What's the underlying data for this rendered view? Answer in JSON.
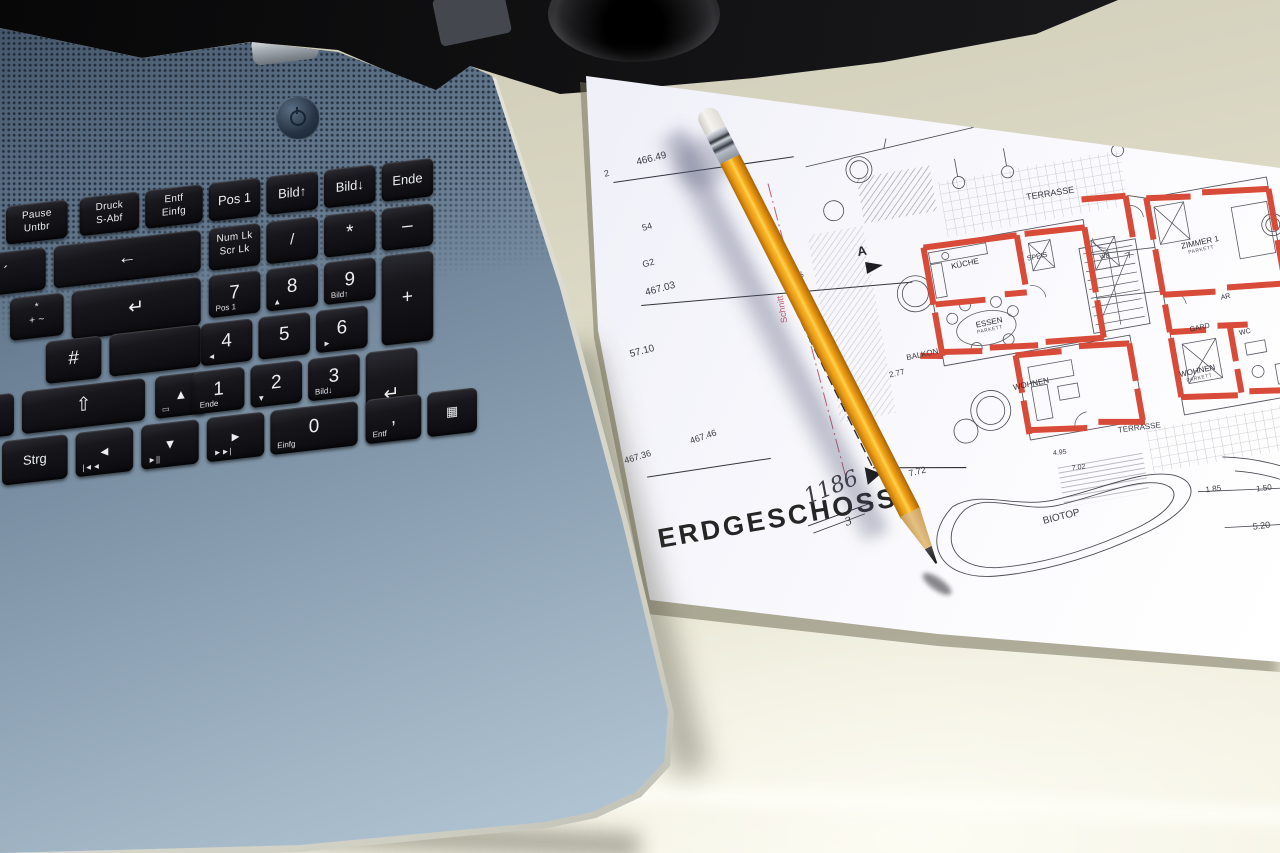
{
  "scene": {
    "type": "photograph",
    "description": "Blue-grey laptop keyboard (German layout) lying beside an architectural ground-floor plan titled ERDGESCHOSS with an orange pencil resting on the paper, on a cream table with a black background at top",
    "objects": [
      "laptop-keyboard",
      "floor-plan-paper",
      "pencil",
      "table-surface",
      "camera-lens-object"
    ],
    "colors": {
      "laptop_blue": "#7d92a4",
      "key_black": "#101014",
      "table_cream": "#e7e4d2",
      "paper_white": "#f3f2f8",
      "plan_wall_red": "#d84b38",
      "plan_line": "#45454e",
      "plan_pink": "#c2596b",
      "plan_green": "#79b06c",
      "pencil_orange": "#f2a01e",
      "pencil_wood": "#d9af6b",
      "background_black": "#0b0b0d"
    }
  },
  "keyboard": {
    "layout": "german",
    "keys": [
      {
        "id": "pause",
        "lines": [
          "Pause",
          "Untbr"
        ],
        "x": -4,
        "y": 2,
        "w": 62,
        "h": 38
      },
      {
        "id": "druck",
        "lines": [
          "Druck",
          "S-Abf"
        ],
        "x": 70,
        "y": 2,
        "w": 60,
        "h": 38
      },
      {
        "id": "entf-einfg",
        "lines": [
          "Entf",
          "Einfg"
        ],
        "x": 136,
        "y": 2,
        "w": 58,
        "h": 38
      },
      {
        "id": "pos1",
        "main": "Pos 1",
        "x": 200,
        "y": 2,
        "w": 52,
        "h": 38,
        "kind": "glyph"
      },
      {
        "id": "bild-up",
        "main": "Bild↑",
        "x": 258,
        "y": 2,
        "w": 52,
        "h": 38,
        "kind": "glyph"
      },
      {
        "id": "bild-down",
        "main": "Bild↓",
        "x": 316,
        "y": 2,
        "w": 52,
        "h": 38,
        "kind": "glyph"
      },
      {
        "id": "ende",
        "main": "Ende",
        "x": 374,
        "y": 2,
        "w": 52,
        "h": 38,
        "kind": "glyph"
      },
      {
        "id": "accent",
        "main": "´",
        "x": -44,
        "y": 47,
        "w": 80,
        "h": 42
      },
      {
        "id": "backspace",
        "main": "←",
        "x": 44,
        "y": 47,
        "w": 148,
        "h": 42,
        "kind": "big"
      },
      {
        "id": "numlock",
        "lines": [
          "Num Lk",
          "Scr Lk"
        ],
        "x": 200,
        "y": 47,
        "w": 52,
        "h": 42
      },
      {
        "id": "np-divide",
        "main": "/",
        "x": 258,
        "y": 47,
        "w": 52,
        "h": 42
      },
      {
        "id": "np-multiply",
        "main": "*",
        "x": 316,
        "y": 47,
        "w": 52,
        "h": 42,
        "kind": "big"
      },
      {
        "id": "np-minus",
        "main": "–",
        "x": 374,
        "y": 47,
        "w": 52,
        "h": 42,
        "kind": "big"
      },
      {
        "id": "plus-star-tilde",
        "lines": [
          "*",
          "+ ~"
        ],
        "x": 0,
        "y": 94,
        "w": 54,
        "h": 42
      },
      {
        "id": "enter-top",
        "main": "↵",
        "x": 62,
        "y": 94,
        "w": 130,
        "h": 48,
        "kind": "big"
      },
      {
        "id": "np7",
        "main": "7",
        "sub": "Pos 1",
        "x": 200,
        "y": 94,
        "w": 52,
        "h": 42,
        "kind": "big"
      },
      {
        "id": "np8",
        "main": "8",
        "sub": "▲",
        "x": 258,
        "y": 94,
        "w": 52,
        "h": 42,
        "kind": "big"
      },
      {
        "id": "np9",
        "main": "9",
        "sub": "Bild↑",
        "x": 316,
        "y": 94,
        "w": 52,
        "h": 42,
        "kind": "big"
      },
      {
        "id": "np-plus",
        "main": "+",
        "x": 374,
        "y": 94,
        "w": 52,
        "h": 89,
        "kind": "big"
      },
      {
        "id": "hash",
        "main": "#",
        "x": 36,
        "y": 141,
        "w": 56,
        "h": 42,
        "kind": "big"
      },
      {
        "id": "enter-bottom",
        "main": "",
        "x": 100,
        "y": 141,
        "w": 92,
        "h": 42
      },
      {
        "id": "np4",
        "main": "4",
        "sub": "◄",
        "x": 192,
        "y": 141,
        "w": 52,
        "h": 42,
        "kind": "big"
      },
      {
        "id": "np5",
        "main": "5",
        "x": 250,
        "y": 141,
        "w": 52,
        "h": 42,
        "kind": "big"
      },
      {
        "id": "np6",
        "main": "6",
        "sub": "►",
        "x": 308,
        "y": 141,
        "w": 52,
        "h": 42,
        "kind": "big"
      },
      {
        "id": "ae",
        "main": "Ä",
        "x": -52,
        "y": 188,
        "w": 56,
        "h": 42,
        "kind": "big"
      },
      {
        "id": "shift",
        "main": "⇧",
        "x": 12,
        "y": 188,
        "w": 124,
        "h": 42,
        "kind": "big"
      },
      {
        "id": "arrow-up",
        "main": "▲",
        "sub": "▭",
        "x": 146,
        "y": 188,
        "w": 52,
        "h": 42,
        "kind": "glyph"
      },
      {
        "id": "np1",
        "main": "1",
        "sub": "Ende",
        "x": 184,
        "y": 188,
        "w": 52,
        "h": 42,
        "kind": "big"
      },
      {
        "id": "np2",
        "main": "2",
        "sub": "▼",
        "x": 242,
        "y": 188,
        "w": 52,
        "h": 42,
        "kind": "big"
      },
      {
        "id": "np3",
        "main": "3",
        "sub": "Bild↓",
        "x": 300,
        "y": 188,
        "w": 52,
        "h": 42,
        "kind": "big"
      },
      {
        "id": "np-enter",
        "main": "↵",
        "x": 358,
        "y": 188,
        "w": 52,
        "h": 89,
        "kind": "big"
      },
      {
        "id": "strg",
        "main": "Strg",
        "x": -8,
        "y": 235,
        "w": 66,
        "h": 44,
        "kind": "glyph"
      },
      {
        "id": "arrow-left",
        "main": "◄",
        "sub": "|◄◄",
        "x": 66,
        "y": 235,
        "w": 58,
        "h": 44,
        "kind": "glyph"
      },
      {
        "id": "arrow-down",
        "main": "▼",
        "sub": "►||",
        "x": 132,
        "y": 235,
        "w": 58,
        "h": 44,
        "kind": "glyph"
      },
      {
        "id": "arrow-right",
        "main": "►",
        "sub": "►►|",
        "x": 198,
        "y": 235,
        "w": 58,
        "h": 44,
        "kind": "glyph"
      },
      {
        "id": "np0",
        "main": "0",
        "sub": "Einfg",
        "x": 262,
        "y": 235,
        "w": 88,
        "h": 44,
        "kind": "big"
      },
      {
        "id": "np-comma",
        "main": ",",
        "sub": "Entf",
        "x": 358,
        "y": 235,
        "w": 56,
        "h": 44,
        "kind": "big"
      },
      {
        "id": "calc",
        "main": "▦",
        "x": 420,
        "y": 235,
        "w": 50,
        "h": 44,
        "kind": "glyph"
      }
    ]
  },
  "plan": {
    "title": "ERDGESCHOSS",
    "labels": [
      {
        "id": "bench-2",
        "text": "2",
        "x": 50,
        "y": 80,
        "size": 9,
        "rot": -4,
        "cls": "dim"
      },
      {
        "id": "bench-466-49",
        "text": "466.49",
        "x": 84,
        "y": 74,
        "size": 10,
        "rot": -4,
        "cls": "dim"
      },
      {
        "id": "num-54",
        "text": "54",
        "x": 78,
        "y": 140,
        "size": 9,
        "rot": -6,
        "cls": "dim"
      },
      {
        "id": "g2",
        "text": "G2",
        "x": 72,
        "y": 176,
        "size": 9,
        "rot": -6,
        "cls": "dim"
      },
      {
        "id": "schnitt",
        "text": "Schnitt",
        "x": 198,
        "y": 262,
        "size": 9,
        "rot": -90,
        "cls": "pink"
      },
      {
        "id": "dim-376",
        "text": "-376-",
        "x": 222,
        "y": 232,
        "size": 8,
        "rot": -86,
        "cls": "dim"
      },
      {
        "id": "bench-467-03",
        "text": "467.03",
        "x": 70,
        "y": 204,
        "size": 10,
        "rot": -5,
        "cls": "dim"
      },
      {
        "id": "num-57-10",
        "text": "57.10",
        "x": 44,
        "y": 262,
        "size": 10,
        "rot": -5,
        "cls": "dim"
      },
      {
        "id": "bench-467-36",
        "text": "467.36",
        "x": 20,
        "y": 366,
        "size": 9,
        "rot": -7,
        "cls": "dim"
      },
      {
        "id": "bench-467-46",
        "text": "467.46",
        "x": 88,
        "y": 358,
        "size": 9,
        "rot": -9,
        "cls": "dim"
      },
      {
        "id": "hand-1186",
        "text": "1186",
        "x": 190,
        "y": 428,
        "size": 22,
        "rot": -12,
        "cls": "hand"
      },
      {
        "id": "hand-3",
        "text": "3",
        "x": 226,
        "y": 464,
        "size": 11,
        "rot": -12,
        "cls": "hand"
      },
      {
        "id": "stamp",
        "text": "ERDGESCHOSS",
        "x": 40,
        "y": 440,
        "size": 27,
        "rot": 0,
        "cls": "stamp"
      },
      {
        "id": "marker-a",
        "text": "A",
        "x": 286,
        "y": 198,
        "size": 13,
        "rot": 0,
        "cls": "bold"
      },
      {
        "id": "marker-b",
        "text": "B",
        "x": 274,
        "y": 416,
        "size": 13,
        "rot": 0,
        "cls": "bold"
      },
      {
        "id": "dim-7-72",
        "text": "7.72",
        "x": 298,
        "y": 428,
        "size": 9,
        "rot": -4,
        "cls": "dim"
      },
      {
        "id": "terrasse-top",
        "text": "TERRASSE",
        "x": 462,
        "y": 176,
        "size": 9,
        "rot": 1,
        "cls": "dim"
      },
      {
        "id": "terrasse-right",
        "text": "TERRASSE",
        "x": 512,
        "y": 422,
        "size": 8,
        "rot": 3,
        "cls": "dim"
      },
      {
        "id": "biotop",
        "text": "BIOTOP",
        "x": 422,
        "y": 498,
        "size": 10,
        "rot": -4,
        "cls": "dim"
      },
      {
        "id": "balkon",
        "text": "BALKON",
        "x": 316,
        "y": 314,
        "size": 8,
        "rot": -2,
        "cls": "dim"
      },
      {
        "id": "kueche",
        "text": "KÜCHE",
        "x": 376,
        "y": 232,
        "size": 8,
        "rot": -2
      },
      {
        "id": "speis",
        "text": "SPEIS",
        "x": 452,
        "y": 238,
        "size": 7,
        "rot": -2
      },
      {
        "id": "wd",
        "text": "WD",
        "x": 524,
        "y": 250,
        "size": 6,
        "rot": -2
      },
      {
        "id": "essen",
        "text": "ESSEN",
        "x": 390,
        "y": 294,
        "size": 8,
        "rot": -2
      },
      {
        "id": "essen-sub",
        "text": "PARKETT",
        "x": 390,
        "y": 303,
        "size": 5,
        "rot": -2,
        "cls": "sub"
      },
      {
        "id": "wohnen-mid",
        "text": "WOHNEN",
        "x": 416,
        "y": 362,
        "size": 8,
        "rot": -2
      },
      {
        "id": "zimmer1",
        "text": "ZIMMER 1",
        "x": 606,
        "y": 252,
        "size": 8,
        "rot": -2
      },
      {
        "id": "zimmer1-sub",
        "text": "PARKETT",
        "x": 612,
        "y": 261,
        "size": 5,
        "rot": -2,
        "cls": "sub"
      },
      {
        "id": "ar",
        "text": "AR",
        "x": 636,
        "y": 310,
        "size": 7,
        "rot": -2
      },
      {
        "id": "gard",
        "text": "GARD",
        "x": 600,
        "y": 336,
        "size": 7,
        "rot": -2
      },
      {
        "id": "wc",
        "text": "WC",
        "x": 648,
        "y": 348,
        "size": 7,
        "rot": -2
      },
      {
        "id": "wohnen-right",
        "text": "WOHNEN",
        "x": 582,
        "y": 378,
        "size": 8,
        "rot": -2
      },
      {
        "id": "wohnen-right-sub",
        "text": "PARKETT",
        "x": 588,
        "y": 387,
        "size": 5,
        "rot": -2,
        "cls": "sub"
      },
      {
        "id": "dim-1-85",
        "text": "1.85",
        "x": 588,
        "y": 496,
        "size": 8,
        "rot": 3,
        "cls": "dim"
      },
      {
        "id": "dim-1-50",
        "text": "1.50",
        "x": 638,
        "y": 504,
        "size": 8,
        "rot": 3,
        "cls": "dim"
      },
      {
        "id": "dim-5-20",
        "text": "5.20",
        "x": 628,
        "y": 540,
        "size": 9,
        "rot": 3,
        "cls": "dim"
      },
      {
        "id": "dim-2-77",
        "text": "2.77",
        "x": 296,
        "y": 328,
        "size": 8,
        "rot": -3,
        "cls": "dim"
      },
      {
        "id": "dim-4-95",
        "text": "4.95",
        "x": 444,
        "y": 434,
        "size": 7,
        "rot": 3,
        "cls": "dim"
      },
      {
        "id": "dim-7-02",
        "text": "7.02",
        "x": 460,
        "y": 452,
        "size": 7,
        "rot": 3,
        "cls": "dim"
      }
    ]
  }
}
